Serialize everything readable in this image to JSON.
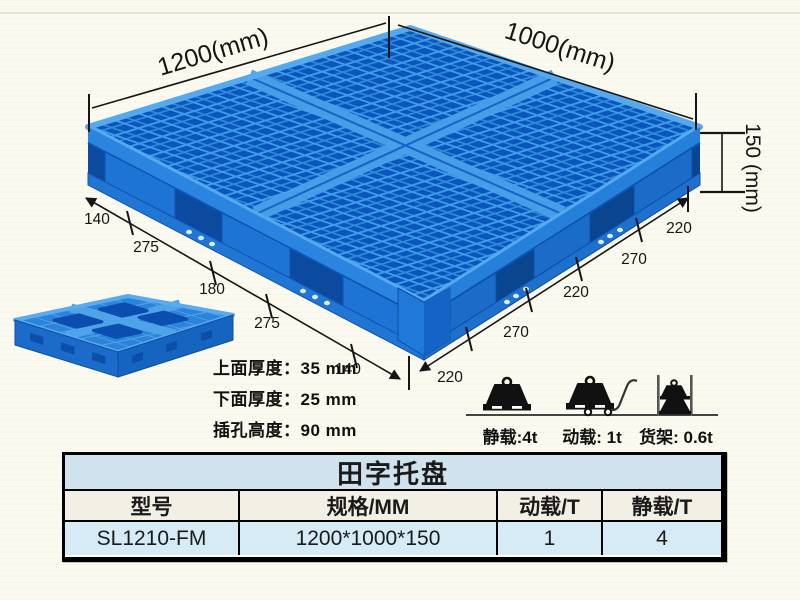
{
  "illustration": {
    "dim_length_label": "1200(mm)",
    "dim_width_label": "1000(mm)",
    "dim_height_label": "150 (mm)",
    "left_chain": [
      "140",
      "275",
      "180",
      "275",
      "140"
    ],
    "right_chain": [
      "220",
      "270",
      "220",
      "270",
      "220"
    ],
    "specs": [
      "上面厚度：35 mm",
      "下面厚度：25 mm",
      "插孔高度：90 mm"
    ],
    "loads": [
      {
        "icon": "static-load-weight-icon",
        "label": "静载:4t"
      },
      {
        "icon": "dynamic-load-trolley-icon",
        "label": "动载: 1t"
      },
      {
        "icon": "rack-load-shelf-icon",
        "label": "货架: 0.6t"
      }
    ],
    "colors": {
      "pallet_blue": "#1f78d4",
      "pallet_dark_blue": "#0b55bd",
      "pallet_light_blue": "#3f9ce8"
    }
  },
  "table": {
    "title": "田字托盘",
    "headers": [
      "型号",
      "规格/MM",
      "动载/T",
      "静载/T"
    ],
    "row": [
      "SL1210-FM",
      "1200*1000*150",
      "1",
      "4"
    ],
    "colors": {
      "title_bg": "#cfe2ee",
      "header_bg": "#f2efe5",
      "row_bg": "#d6ebf6"
    }
  }
}
